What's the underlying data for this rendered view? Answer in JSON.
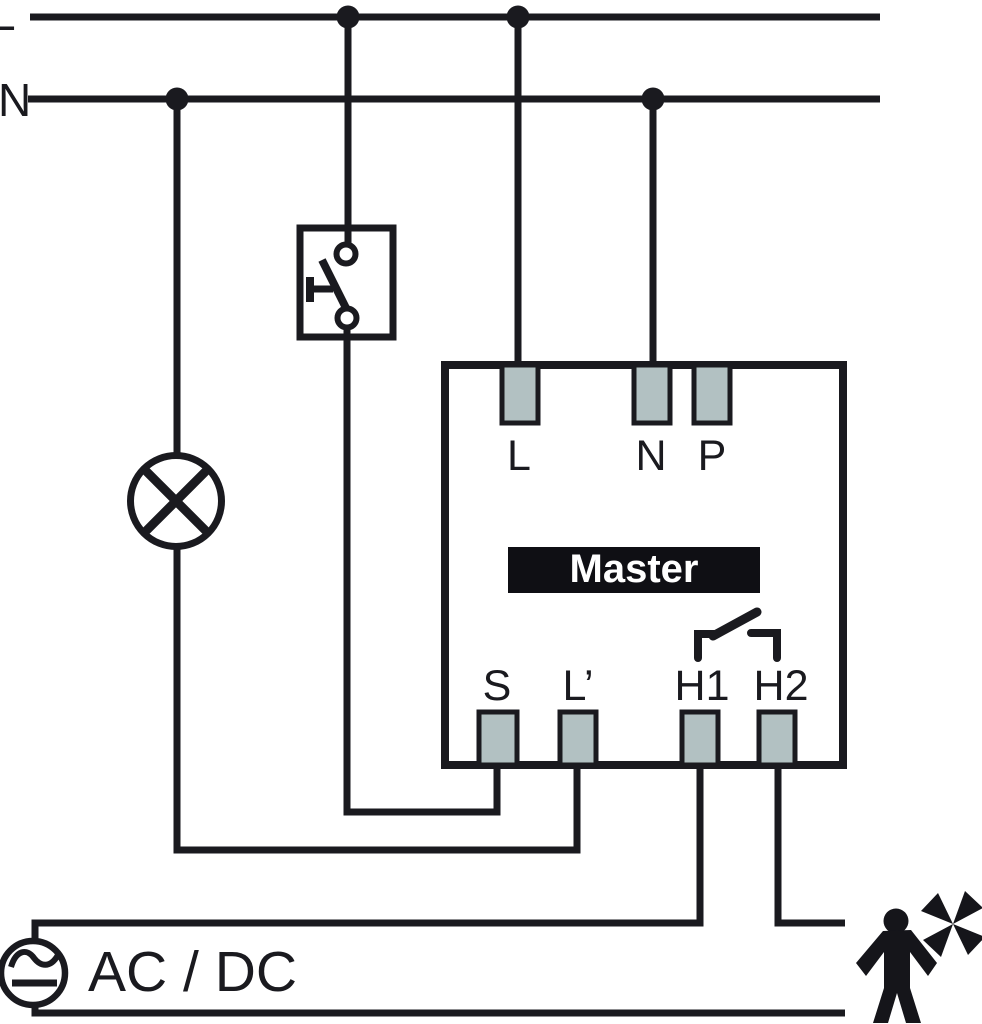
{
  "buses": {
    "live_label": "L",
    "neutral_label": "N"
  },
  "device": {
    "name": "Master",
    "top_terminals": [
      "L",
      "N",
      "P"
    ],
    "bottom_terminals": [
      "S",
      "L’",
      "H1",
      "H2"
    ]
  },
  "source": {
    "label": "AC / DC"
  },
  "icons": {
    "lamp": "lamp-icon",
    "switch": "push-button-switch-icon",
    "relay": "relay-contact-icon",
    "source": "ac-dc-source-icon",
    "load": "person-fan-icon"
  },
  "colors": {
    "wire": "#1a1a1f",
    "terminal_fill": "#b2c1c2",
    "terminal_border": "#1a1a1f",
    "label_bg": "#0f0f14",
    "label_text": "#ffffff",
    "background": "#ffffff"
  }
}
